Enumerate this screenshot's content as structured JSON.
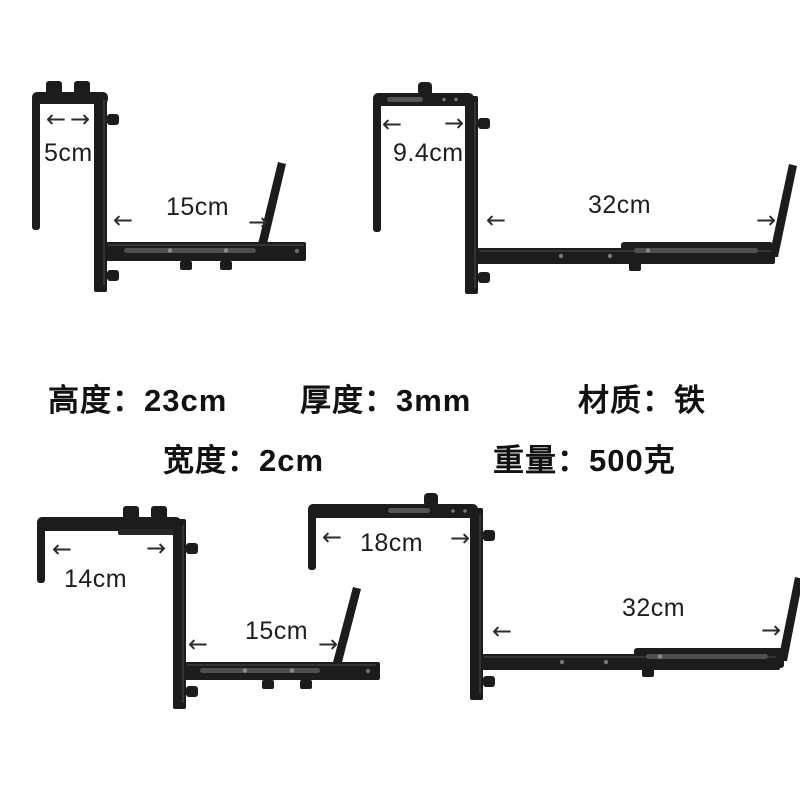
{
  "specs": {
    "row1": [
      "高度：23cm",
      "厚度：3mm",
      "材质：铁"
    ],
    "row2": [
      "宽度：2cm",
      "重量：500克"
    ]
  },
  "brackets": [
    {
      "position": "top-left",
      "hook_width": "5cm",
      "arm_length": "15cm"
    },
    {
      "position": "top-right",
      "hook_width": "9.4cm",
      "arm_length": "32cm"
    },
    {
      "position": "bottom-left",
      "hook_width": "14cm",
      "arm_length": "15cm"
    },
    {
      "position": "bottom-right",
      "hook_width": "18cm",
      "arm_length": "32cm"
    }
  ],
  "icons": {
    "arrow_left": "←",
    "arrow_right": "→"
  },
  "colors": {
    "metal": "#1c1c1c",
    "text": "#1a1a1a",
    "background": "#ffffff"
  }
}
